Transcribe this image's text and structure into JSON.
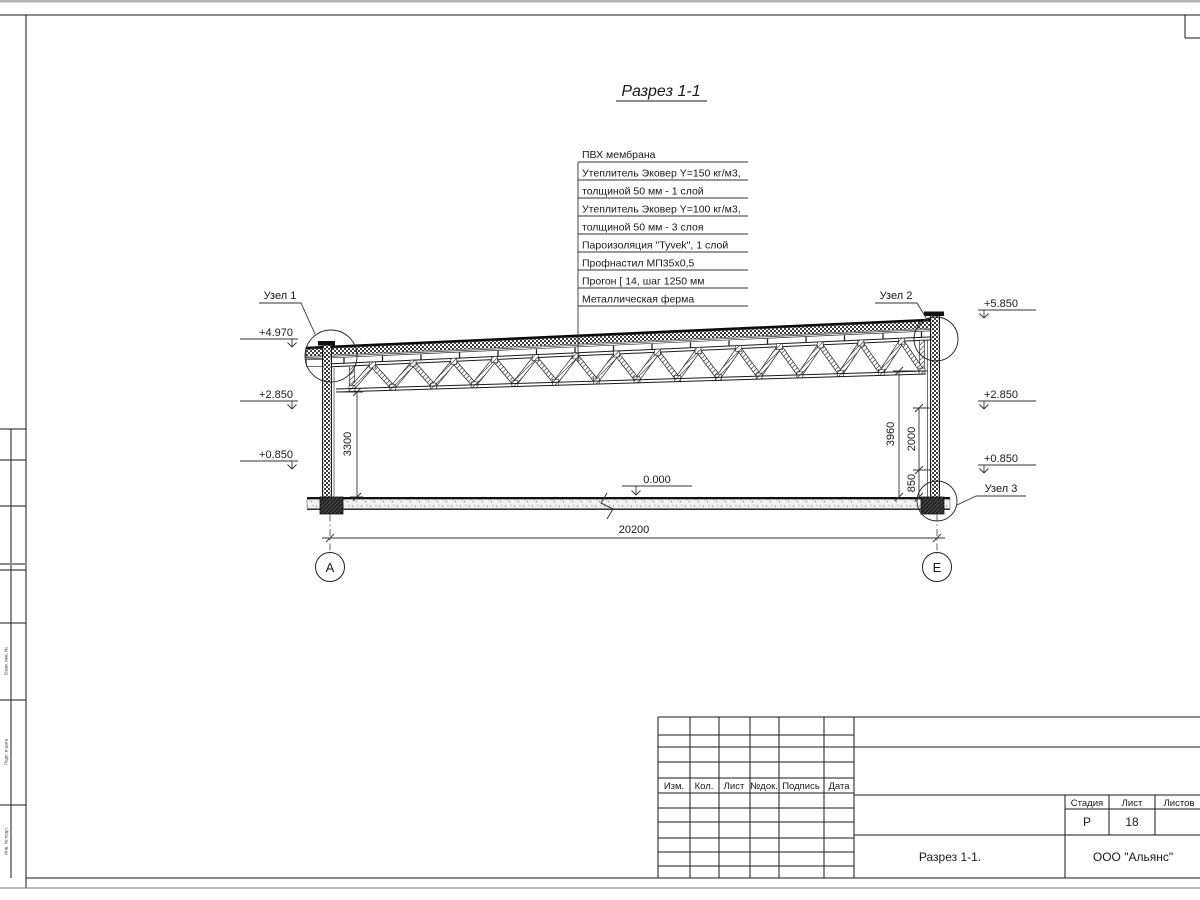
{
  "sheet": {
    "title": "Разрез 1-1"
  },
  "callout": {
    "items": [
      "ПВХ мембрана",
      "Утеплитель Эковер Y=150 кг/м3,",
      "толщиной 50 мм - 1 слой",
      "Утеплитель Эковер Y=100 кг/м3,",
      "толщиной 50 мм - 3 слоя",
      "Пароизоляция \"Tyvek\", 1 слой",
      "Профнастил МП35х0,5",
      "Прогон [ 14, шаг 1250 мм",
      "Металлическая ферма"
    ]
  },
  "levels": {
    "l1": "+4.970",
    "l2": "+2.850",
    "l3": "+0.850",
    "r1": "+5.850",
    "r2": "+2.850",
    "r3": "+0.850",
    "zero": "0.000"
  },
  "nodes": {
    "n1": "Узел 1",
    "n2": "Узел 2",
    "n3": "Узел 3"
  },
  "dims": {
    "span": "20200",
    "h_left": "3300",
    "h_right": "3960",
    "h_upper": "2000",
    "h_lower": "850"
  },
  "axes": {
    "a": "А",
    "e": "Е"
  },
  "titleblock": {
    "cols": [
      "Изм.",
      "Кол.",
      "Лист",
      "№док.",
      "Подпись",
      "Дата"
    ],
    "stage_label": "Стадия",
    "sheet_label": "Лист",
    "sheets_label": "Листов",
    "stage": "Р",
    "sheet_no": "18",
    "doc_title": "Разрез 1-1.",
    "company": "ООО \"Альянс\""
  },
  "frame": {
    "v1": "Взам. инв. №",
    "v2": "Подп. и дата",
    "v3": "Инв. № подл."
  }
}
